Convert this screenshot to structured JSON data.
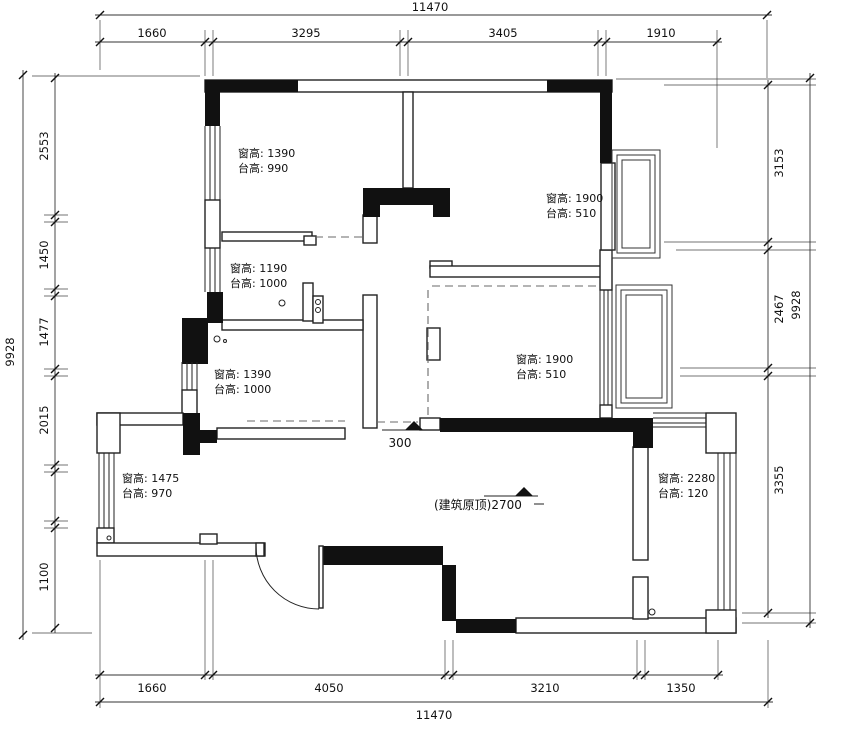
{
  "title": "floor-plan-original-structure",
  "dims": {
    "top": {
      "overall": "11470",
      "segments": [
        "1660",
        "3295",
        "3405",
        "1910"
      ]
    },
    "bottom": {
      "overall": "11470",
      "segments": [
        "1660",
        "4050",
        "3210",
        "1350"
      ]
    },
    "left": {
      "overall": "9928",
      "segments": [
        "2553",
        "1450",
        "1477",
        "2015",
        "1100"
      ]
    },
    "right": {
      "overall": "9928",
      "segments": [
        "3153",
        "2467",
        "3355"
      ]
    }
  },
  "annotations": {
    "room_a": {
      "line1": "窗高: 1390",
      "line2": "台高: 990"
    },
    "room_b": {
      "line1": "窗高: 1900",
      "line2": "台高: 510"
    },
    "room_d": {
      "line1": "窗高: 1190",
      "line2": "台高: 1000"
    },
    "room_e": {
      "line1": "窗高: 1390",
      "line2": "台高: 1000"
    },
    "room_c": {
      "line1": "窗高: 1900",
      "line2": "台高: 510"
    },
    "room_f": {
      "line1": "窗高: 1475",
      "line2": "台高: 970"
    },
    "room_g": {
      "line1": "窗高: 2280",
      "line2": "台高: 120"
    },
    "level_entry": "300",
    "ceiling": "(建筑原顶)2700"
  }
}
